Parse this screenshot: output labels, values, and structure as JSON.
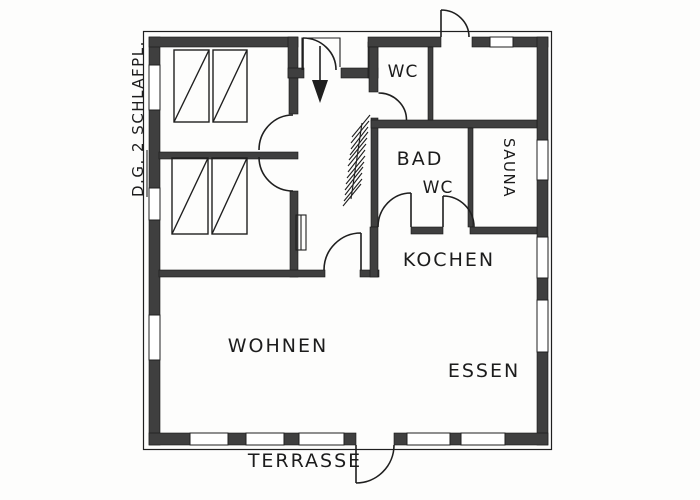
{
  "drawing": {
    "floor_label": {
      "underlined": "D.G.",
      "rest": " 2 SCHLAFPL."
    },
    "rooms": {
      "wc_top": "WC",
      "bath": "BAD",
      "bath_wc": "WC",
      "sauna": "SAUNA",
      "kitchen": "KOCHEN",
      "living": "WOHNEN",
      "dining": "ESSEN",
      "terrace": "TERRASSE"
    },
    "symbols": {
      "beds": "2 double-bed symbols (hatched rectangles)",
      "entrance_arrow": "black arrow marking main entry",
      "stairs": "hatched stair run beside bath wall",
      "radiator": "small radiator on hallway wall",
      "doors": "swing arcs at entry, wc, bath, sauna, bedrooms, living room, terrace",
      "windows": "white gaps in dark exterior walls"
    },
    "colors": {
      "wall": "#3f3f3f",
      "line": "#1f1f1f",
      "paper": "#fdfdfc",
      "text": "#1c1c1c"
    }
  }
}
